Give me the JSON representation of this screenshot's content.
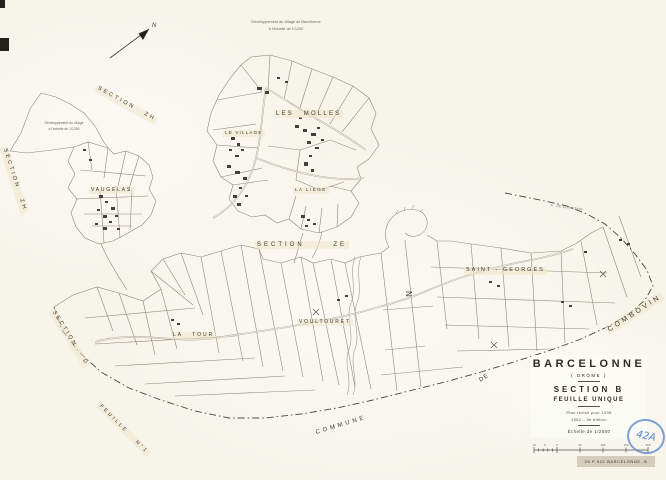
{
  "compass": {
    "label": "N"
  },
  "notes": {
    "top_line1": "Développement du village de Barcelonne",
    "top_line2": "à l'échelle de 1/1250",
    "left_line1": "Développement du village",
    "left_line2": "à l'échelle de 1/1250"
  },
  "sections": {
    "zh_top": "SECTION ZH",
    "zh_left": "SECTION ZH",
    "ze": "SECTION ZE",
    "d": "SECTION D",
    "feuille1": "FEUILLE N°1"
  },
  "places": {
    "vaugelas": "VAUGELAS",
    "le_village": "LE VILLAGE",
    "les_molles": "LES MOLLES",
    "la_liege": "LA LIÈGE",
    "la_tour": "LA TOUR",
    "voultouret": "VOULTOURET",
    "saint_georges": "SAINT - GEORGES",
    "combovin": "COMBOVIN",
    "de": "DE",
    "commune": "COMMUNE",
    "n_letter": "N",
    "road_combovin": "C. DE COMBOVIN"
  },
  "title_block": {
    "commune": "BARCELONNE",
    "departement": "( DRÔME )",
    "section": "SECTION B",
    "feuille": "FEUILLE UNIQUE",
    "revision_line1": "Plan révisé pour 1936",
    "revision_line2": "1952 – 3e édition",
    "echelle": "Échelle de 1/2500"
  },
  "scale_bar": {
    "numbers": [
      "10",
      "5",
      "0",
      "50",
      "100",
      "150",
      "200"
    ]
  },
  "stamps": {
    "archive_ref": "26 P 522 BARCELONNE. B",
    "blue_mark": "42A"
  },
  "colors": {
    "paper": "#f7f4ea",
    "ink": "#3e3a31",
    "line": "#8d887a",
    "blue": "#4f86cc"
  }
}
